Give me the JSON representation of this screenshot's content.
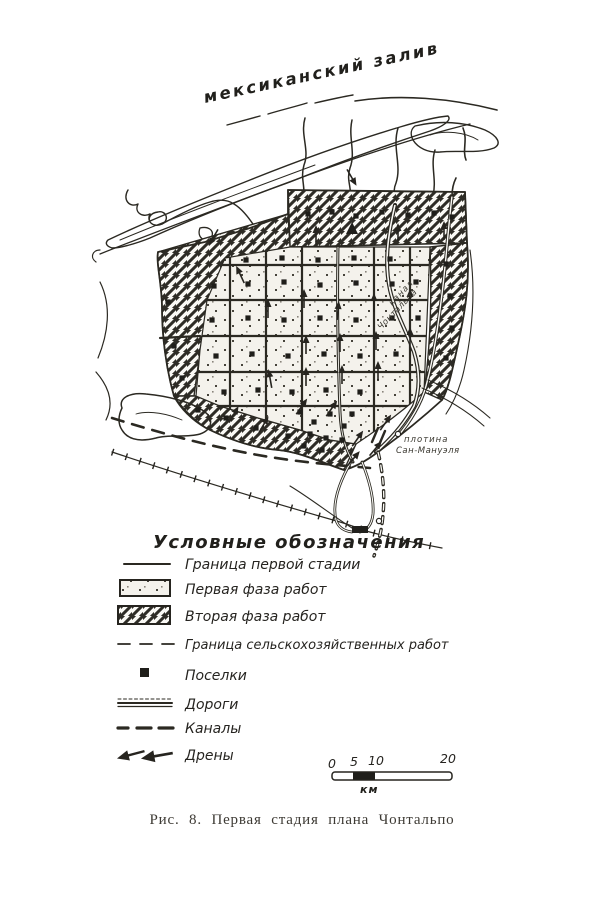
{
  "figure": {
    "sea_label": "мексиканский залив",
    "river_label_line1": "канал",
    "river_label_line2": "Чонтальпа",
    "dam_label_line1": "плотина",
    "dam_label_line2": "Сан-Мануэля"
  },
  "legend": {
    "title": "Условные обозначения",
    "items": [
      {
        "symbol": "first-stage-boundary-line",
        "label": "Граница первой стадии"
      },
      {
        "symbol": "dotted-area",
        "label": "Первая фаза работ"
      },
      {
        "symbol": "hatched-area",
        "label": "Вторая фаза работ"
      },
      {
        "symbol": "dashed-boundary-line",
        "label": "Граница сельскохозяйственных работ"
      },
      {
        "symbol": "settlement-square",
        "label": "Поселки"
      },
      {
        "symbol": "road-double-line",
        "label": "Дороги"
      },
      {
        "symbol": "canal-dash-line",
        "label": "Каналы"
      },
      {
        "symbol": "drain-arrows",
        "label": "Дрены"
      }
    ]
  },
  "scale_bar": {
    "tick_labels": [
      "0",
      "5",
      "10",
      "20"
    ],
    "unit_label": "км"
  },
  "caption": "Рис. 8. Первая стадия плана Чонтальпо",
  "colors": {
    "paper": "#ffffff",
    "ink": "#2b2922",
    "caption_ink": "#3d3a34"
  }
}
